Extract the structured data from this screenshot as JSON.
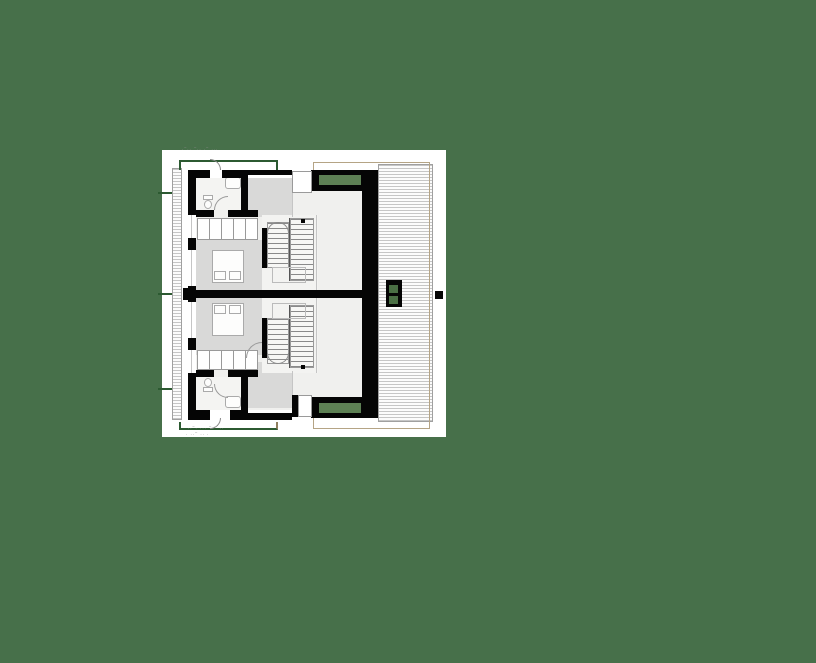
{
  "scene": {
    "description": "Architectural upper-floor plan of a mirrored duplex house, drawn on a white sheet over a plain green background",
    "background_color": "#47704a",
    "sheet_color": "#ffffff"
  },
  "palette": {
    "wall_black": "#050505",
    "room_gray": "#d9d9d8",
    "interior_light": "#f0f0ee",
    "bath_light": "#f4f4f2",
    "accent_green": "#5d8054",
    "chimney_green": "#4a6f44",
    "terrace_outline_green": "#2c5a31",
    "roof_outline_tan": "#b5a485",
    "hatch_line_gray": "#c6c6c6",
    "stair_line_gray": "#8a8a8a"
  },
  "annotations": {
    "top_dimension_marks": "·‾·· ‾·· ·‾ ···",
    "bottom_dimension_marks": "··‾· ··· ‾·‾ ··",
    "bottom_dimension_marks_2": "· ··‾ ·· ·"
  }
}
